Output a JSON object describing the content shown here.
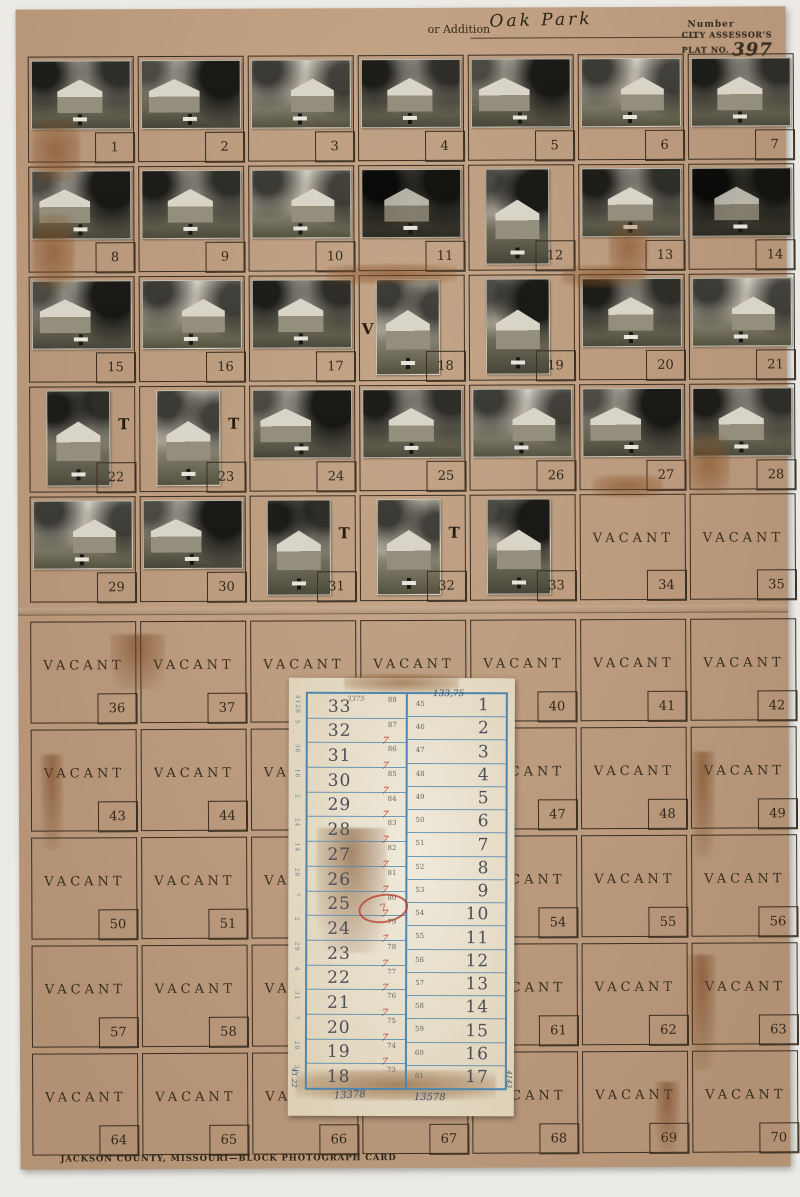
{
  "header": {
    "or_addition_label": "or Addition",
    "addition_name": "Oak Park",
    "number_label": "Number",
    "stamp_line1": "CITY ASSESSOR'S",
    "stamp_line2": "PLAT NO.",
    "plat_no": "397"
  },
  "footer": {
    "caption": "JACKSON COUNTY, MISSOURI—BLOCK PHOTOGRAPH CARD"
  },
  "grid": {
    "vacant_label": "VACANT",
    "top_cells": [
      {
        "n": "1",
        "kind": "photo",
        "orient": "l",
        "style": "a"
      },
      {
        "n": "2",
        "kind": "photo",
        "orient": "l",
        "style": "b"
      },
      {
        "n": "3",
        "kind": "photo",
        "orient": "l",
        "style": "c"
      },
      {
        "n": "4",
        "kind": "photo",
        "orient": "l",
        "style": "a"
      },
      {
        "n": "5",
        "kind": "photo",
        "orient": "l",
        "style": "b"
      },
      {
        "n": "6",
        "kind": "photo",
        "orient": "l",
        "style": "c"
      },
      {
        "n": "7",
        "kind": "photo",
        "orient": "l",
        "style": "a"
      },
      {
        "n": "8",
        "kind": "photo",
        "orient": "l",
        "style": "b"
      },
      {
        "n": "9",
        "kind": "photo",
        "orient": "l",
        "style": "a"
      },
      {
        "n": "10",
        "kind": "photo",
        "orient": "l",
        "style": "c"
      },
      {
        "n": "11",
        "kind": "photo",
        "orient": "l",
        "style": "d"
      },
      {
        "n": "12",
        "kind": "photo",
        "orient": "p",
        "style": "b"
      },
      {
        "n": "13",
        "kind": "photo",
        "orient": "l",
        "style": "a"
      },
      {
        "n": "14",
        "kind": "photo",
        "orient": "l",
        "style": "d"
      },
      {
        "n": "15",
        "kind": "photo",
        "orient": "l",
        "style": "b"
      },
      {
        "n": "16",
        "kind": "photo",
        "orient": "l",
        "style": "c"
      },
      {
        "n": "17",
        "kind": "photo",
        "orient": "l",
        "style": "a"
      },
      {
        "n": "18",
        "kind": "photo",
        "orient": "p",
        "style": "c",
        "mark": "V",
        "side": "left"
      },
      {
        "n": "19",
        "kind": "photo",
        "orient": "p",
        "style": "b"
      },
      {
        "n": "20",
        "kind": "photo",
        "orient": "l",
        "style": "a"
      },
      {
        "n": "21",
        "kind": "photo",
        "orient": "l",
        "style": "c"
      },
      {
        "n": "22",
        "kind": "photo",
        "orient": "p",
        "style": "a",
        "mark": "T",
        "side": "right"
      },
      {
        "n": "23",
        "kind": "photo",
        "orient": "p",
        "style": "c",
        "mark": "T",
        "side": "right"
      },
      {
        "n": "24",
        "kind": "photo",
        "orient": "l",
        "style": "b"
      },
      {
        "n": "25",
        "kind": "photo",
        "orient": "l",
        "style": "a"
      },
      {
        "n": "26",
        "kind": "photo",
        "orient": "l",
        "style": "c"
      },
      {
        "n": "27",
        "kind": "photo",
        "orient": "l",
        "style": "b"
      },
      {
        "n": "28",
        "kind": "photo",
        "orient": "l",
        "style": "a"
      },
      {
        "n": "29",
        "kind": "photo",
        "orient": "l",
        "style": "c"
      },
      {
        "n": "30",
        "kind": "photo",
        "orient": "l",
        "style": "b"
      },
      {
        "n": "31",
        "kind": "photo",
        "orient": "p",
        "style": "a",
        "mark": "T",
        "side": "right"
      },
      {
        "n": "32",
        "kind": "photo",
        "orient": "p",
        "style": "c",
        "mark": "T",
        "side": "right"
      },
      {
        "n": "33",
        "kind": "photo",
        "orient": "p",
        "style": "b"
      },
      {
        "n": "34",
        "kind": "vacant"
      },
      {
        "n": "35",
        "kind": "vacant"
      }
    ],
    "bottom_cells": [
      {
        "n": "36",
        "kind": "vacant"
      },
      {
        "n": "37",
        "kind": "vacant"
      },
      {
        "n": "38",
        "kind": "vacant"
      },
      {
        "n": "39",
        "kind": "vacant"
      },
      {
        "n": "40",
        "kind": "vacant"
      },
      {
        "n": "41",
        "kind": "vacant"
      },
      {
        "n": "42",
        "kind": "vacant"
      },
      {
        "n": "43",
        "kind": "vacant"
      },
      {
        "n": "44",
        "kind": "vacant"
      },
      {
        "n": "45",
        "kind": "vacant"
      },
      {
        "n": "46",
        "kind": "vacant"
      },
      {
        "n": "47",
        "kind": "vacant"
      },
      {
        "n": "48",
        "kind": "vacant"
      },
      {
        "n": "49",
        "kind": "vacant"
      },
      {
        "n": "50",
        "kind": "vacant"
      },
      {
        "n": "51",
        "kind": "vacant"
      },
      {
        "n": "52",
        "kind": "vacant"
      },
      {
        "n": "53",
        "kind": "vacant"
      },
      {
        "n": "54",
        "kind": "vacant"
      },
      {
        "n": "55",
        "kind": "vacant"
      },
      {
        "n": "56",
        "kind": "vacant"
      },
      {
        "n": "57",
        "kind": "vacant"
      },
      {
        "n": "58",
        "kind": "vacant"
      },
      {
        "n": "59",
        "kind": "vacant"
      },
      {
        "n": "60",
        "kind": "vacant"
      },
      {
        "n": "61",
        "kind": "vacant"
      },
      {
        "n": "62",
        "kind": "vacant"
      },
      {
        "n": "63",
        "kind": "vacant"
      },
      {
        "n": "64",
        "kind": "vacant"
      },
      {
        "n": "65",
        "kind": "vacant"
      },
      {
        "n": "66",
        "kind": "vacant"
      },
      {
        "n": "67",
        "kind": "vacant"
      },
      {
        "n": "68",
        "kind": "vacant"
      },
      {
        "n": "69",
        "kind": "vacant"
      },
      {
        "n": "70",
        "kind": "vacant"
      }
    ]
  },
  "ledger": {
    "left_rows": [
      {
        "lot": "33",
        "sub": "88",
        "mark": false
      },
      {
        "lot": "32",
        "sub": "87",
        "mark": true
      },
      {
        "lot": "31",
        "sub": "86",
        "mark": true
      },
      {
        "lot": "30",
        "sub": "85",
        "mark": true
      },
      {
        "lot": "29",
        "sub": "84",
        "mark": true
      },
      {
        "lot": "28",
        "sub": "83",
        "mark": true
      },
      {
        "lot": "27",
        "sub": "82",
        "mark": true
      },
      {
        "lot": "26",
        "sub": "81",
        "mark": true
      },
      {
        "lot": "25",
        "sub": "80",
        "mark": true
      },
      {
        "lot": "24",
        "sub": "79",
        "mark": true
      },
      {
        "lot": "23",
        "sub": "78",
        "mark": true
      },
      {
        "lot": "22",
        "sub": "77",
        "mark": true
      },
      {
        "lot": "21",
        "sub": "76",
        "mark": true
      },
      {
        "lot": "20",
        "sub": "75",
        "mark": true
      },
      {
        "lot": "19",
        "sub": "74",
        "mark": true
      },
      {
        "lot": "18",
        "sub": "73",
        "mark": false
      }
    ],
    "right_rows": [
      {
        "lot": "1",
        "sub": "45"
      },
      {
        "lot": "2",
        "sub": "46"
      },
      {
        "lot": "3",
        "sub": "47"
      },
      {
        "lot": "4",
        "sub": "48"
      },
      {
        "lot": "5",
        "sub": "49"
      },
      {
        "lot": "6",
        "sub": "50"
      },
      {
        "lot": "7",
        "sub": "51"
      },
      {
        "lot": "8",
        "sub": "52"
      },
      {
        "lot": "9",
        "sub": "53"
      },
      {
        "lot": "10",
        "sub": "54"
      },
      {
        "lot": "11",
        "sub": "55"
      },
      {
        "lot": "12",
        "sub": "56"
      },
      {
        "lot": "13",
        "sub": "57"
      },
      {
        "lot": "14",
        "sub": "58"
      },
      {
        "lot": "15",
        "sub": "59"
      },
      {
        "lot": "16",
        "sub": "60"
      },
      {
        "lot": "17",
        "sub": "61"
      }
    ],
    "edge_notes": [
      "4128",
      "5",
      "36",
      "16",
      "2",
      "24",
      "14",
      "26",
      "7",
      "2",
      "29",
      "4",
      "31",
      "7",
      "28",
      "30"
    ],
    "annotations": {
      "top_left": "3375",
      "top_right": "133,75",
      "bottom_left": "13378",
      "bottom_right": "13578",
      "edge_left": "41.22",
      "edge_right": "4143",
      "stamp_text": "7"
    }
  },
  "colors": {
    "card_tan": "#c29e7e",
    "grid_line": "#3a2f22",
    "ledger_paper": "#e9e0ca",
    "ledger_blue": "#4f86ad",
    "stamp_red": "#b53a2c"
  }
}
